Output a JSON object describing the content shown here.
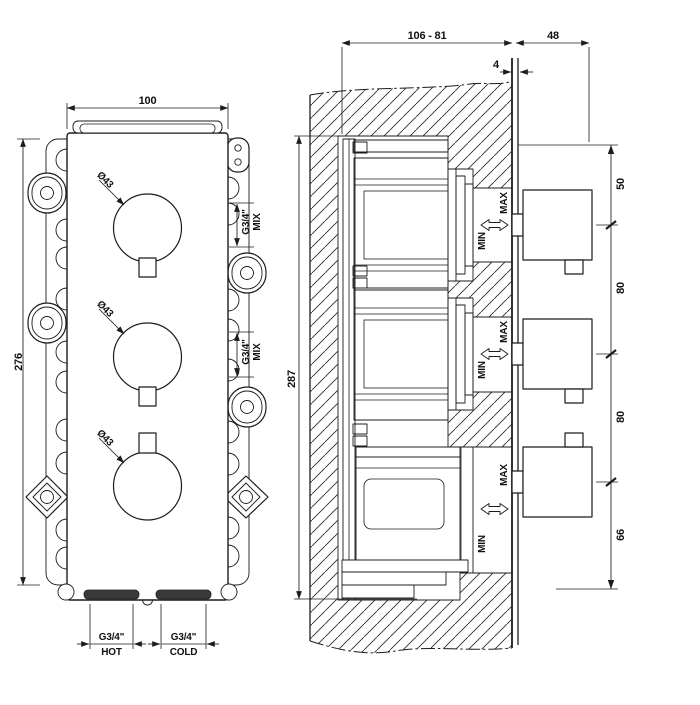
{
  "drawing": {
    "left_view": {
      "width_dim": "100",
      "height_dim": "276",
      "knobs": [
        {
          "diameter": "Ø43"
        },
        {
          "diameter": "Ø43"
        },
        {
          "diameter": "Ø43"
        }
      ],
      "mix_ports": [
        {
          "size": "G3/4\"",
          "label": "MIX"
        },
        {
          "size": "G3/4\"",
          "label": "MIX"
        }
      ],
      "hot_port": {
        "size": "G3/4\"",
        "label": "HOT"
      },
      "cold_port": {
        "size": "G3/4\"",
        "label": "COLD"
      }
    },
    "right_view": {
      "depth_range_dim": "106 - 81",
      "handle_depth_dim": "48",
      "plate_thickness_dim": "4",
      "height_dim": "287",
      "spacing_dims": [
        "50",
        "80",
        "80",
        "66"
      ],
      "valves": [
        {
          "min": "MIN",
          "max": "MAX"
        },
        {
          "min": "MIN",
          "max": "MAX"
        },
        {
          "min": "MIN",
          "max": "MAX"
        }
      ]
    }
  }
}
